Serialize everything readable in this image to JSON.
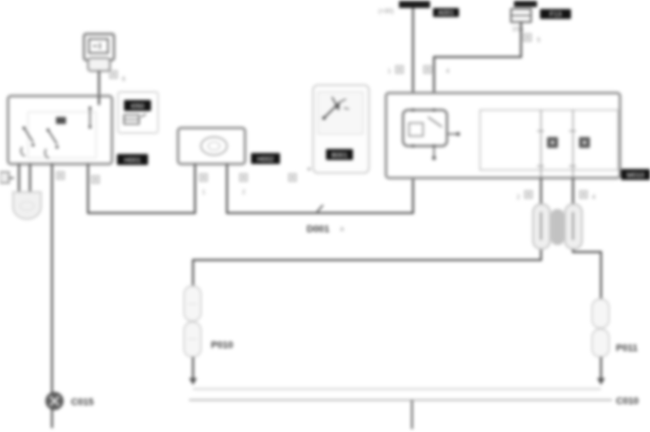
{
  "diagram": {
    "type": "automotive-wiring-schematic",
    "colors": {
      "background": "#ffffff",
      "wire": "#4f4f4f",
      "box_stroke": "#8d8d8d",
      "phantom_stroke": "#c9c9c9",
      "label_bg": "#141414",
      "label_text": "#ffffff",
      "code_text": "#383838"
    },
    "labels": {
      "plus30": "(+30)",
      "node_a_tag": "A001",
      "fuse_tag": "F13",
      "fuse_rating": "10A",
      "pin_t1": "6",
      "pin_bat": "1",
      "pin_fused": "4",
      "pin_fuse_out": "5",
      "tag_left_unit": "H001",
      "tag_aux_unit": "I050",
      "tag_mid_unit": "H002",
      "tag_phantom": "B001",
      "tag_main_unit": "M010",
      "pin_b2_left": "1",
      "pin_b2_right": "2",
      "splice": "D001",
      "splice_suffix": "a",
      "pin_box_left": "2",
      "pin_box_right": "4",
      "ground": "C015",
      "load_left": "P010",
      "load_right": "P011",
      "bottom_right": "C010"
    }
  }
}
